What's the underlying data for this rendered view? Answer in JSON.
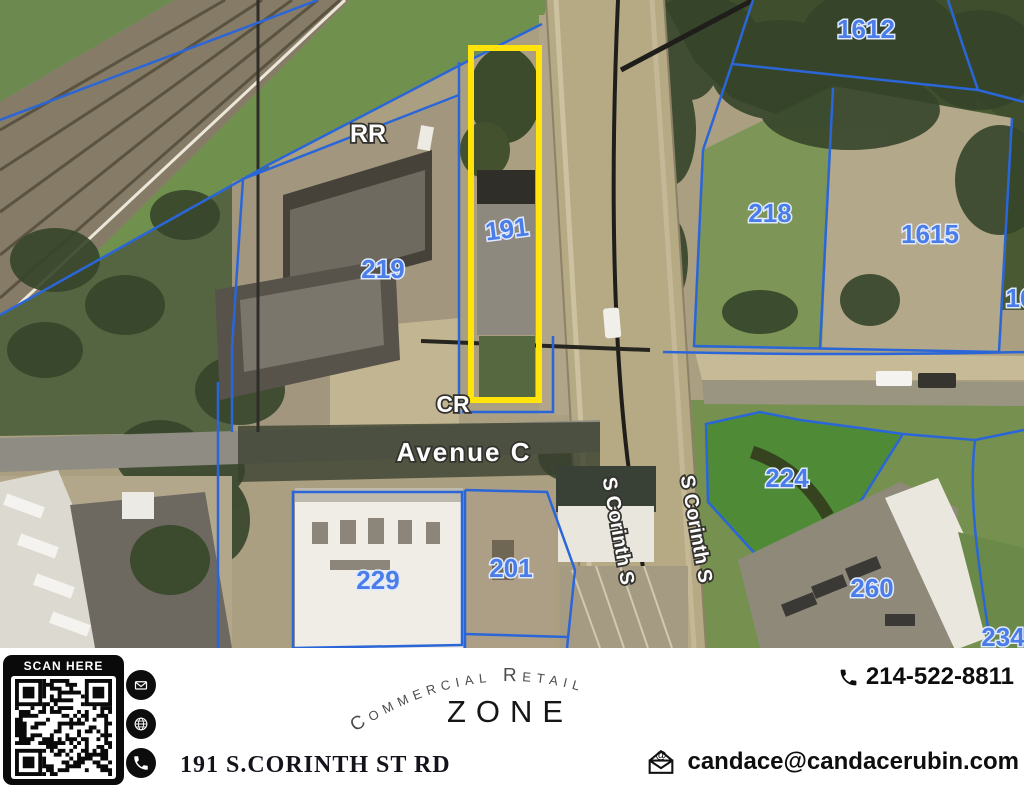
{
  "map": {
    "highlight_color": "#ffe30a",
    "parcel_line_color": "#2b66d9",
    "parcel_label_color": "#4a7de8",
    "parcel_labels": [
      {
        "text": "1612"
      },
      {
        "text": "218"
      },
      {
        "text": "1615"
      },
      {
        "text": "16"
      },
      {
        "text": "219"
      },
      {
        "text": "191"
      },
      {
        "text": "224"
      },
      {
        "text": "260"
      },
      {
        "text": "234"
      },
      {
        "text": "229"
      },
      {
        "text": "201"
      }
    ],
    "street_labels": [
      {
        "text": "RR"
      },
      {
        "text": "CR"
      },
      {
        "text": "Avenue C"
      },
      {
        "text": "S Corinth S"
      },
      {
        "text": "S Corinth S"
      }
    ]
  },
  "footer": {
    "scan_label": "SCAN HERE",
    "address": "191 S.CORINTH ST RD",
    "arc_title": "Commercial Retail",
    "zone_label": "ZONE",
    "phone": "214-522-8811",
    "email": "candace@candacerubin.com",
    "email_icon_glyph": "@",
    "icons": [
      "envelope-icon",
      "globe-icon",
      "phone-icon",
      "qr-code"
    ]
  }
}
